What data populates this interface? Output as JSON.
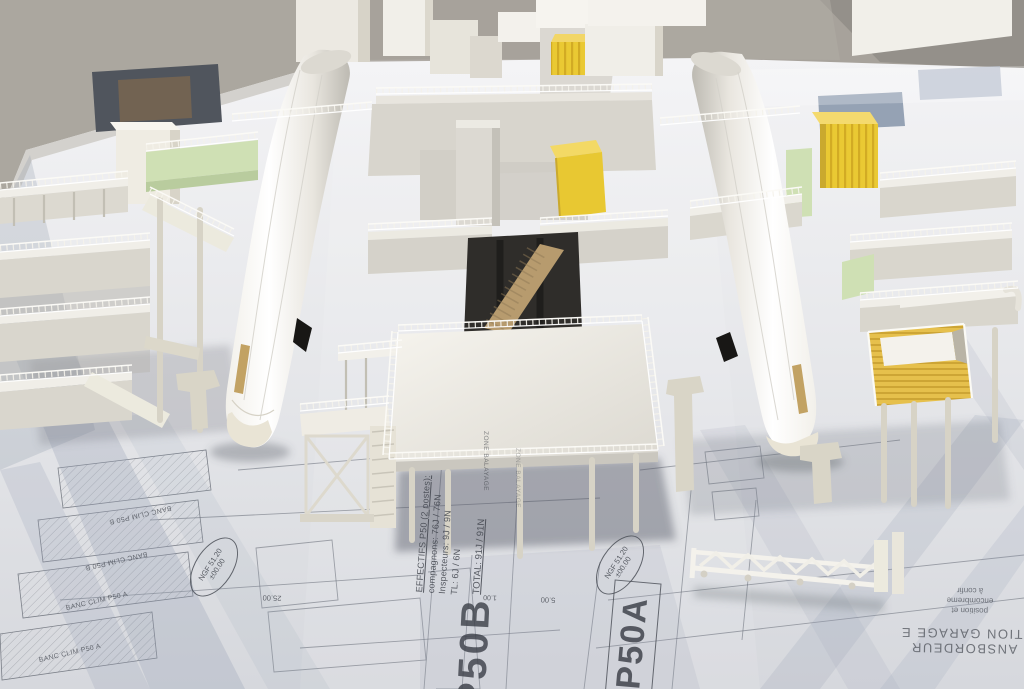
{
  "colors": {
    "hangar_floor": "#a7a29b",
    "table_top": "#e7e8ec",
    "reflection_blue": "#8494ad",
    "plan_line": "#636872",
    "plan_text": "#41454d",
    "model_white": "#f6f4ef",
    "model_cream": "#e9e5d9",
    "accent_yellow": "#e9c93a",
    "accent_green": "#cfe0b4",
    "fuselage_gold": "#c2a263",
    "opening_dark": "#2f2d2a"
  },
  "plan": {
    "staffing": {
      "line1": "EFFECTIFS P50 (2 postes):",
      "line2": "compagnons: 76J / 76N",
      "line3": "Inspecteurs: 9J / 9N",
      "line4": "TL: 6J / 6N",
      "total": "TOTAL: 91J / 91N"
    },
    "station_b_label": "P50B",
    "station_a_label": "P50A",
    "level_marker_line1": "NGF 51.20",
    "level_marker_line2": "±00.00",
    "zone_label": "ZONE BALAYAGE",
    "banc_clim_b_label": "BANC CLIM P50 B",
    "banc_clim_a_label": "BANC CLIM P50 A",
    "dim_25": "25.00",
    "dim_1": "1.00",
    "dim_5": "5.00",
    "garage_text_line_top": "ITION GARAGE E",
    "garage_text_line_bottom": "ANSBORDEUR",
    "note_line1": "position et",
    "note_line2": "encombreme",
    "note_line3": "à confir"
  }
}
